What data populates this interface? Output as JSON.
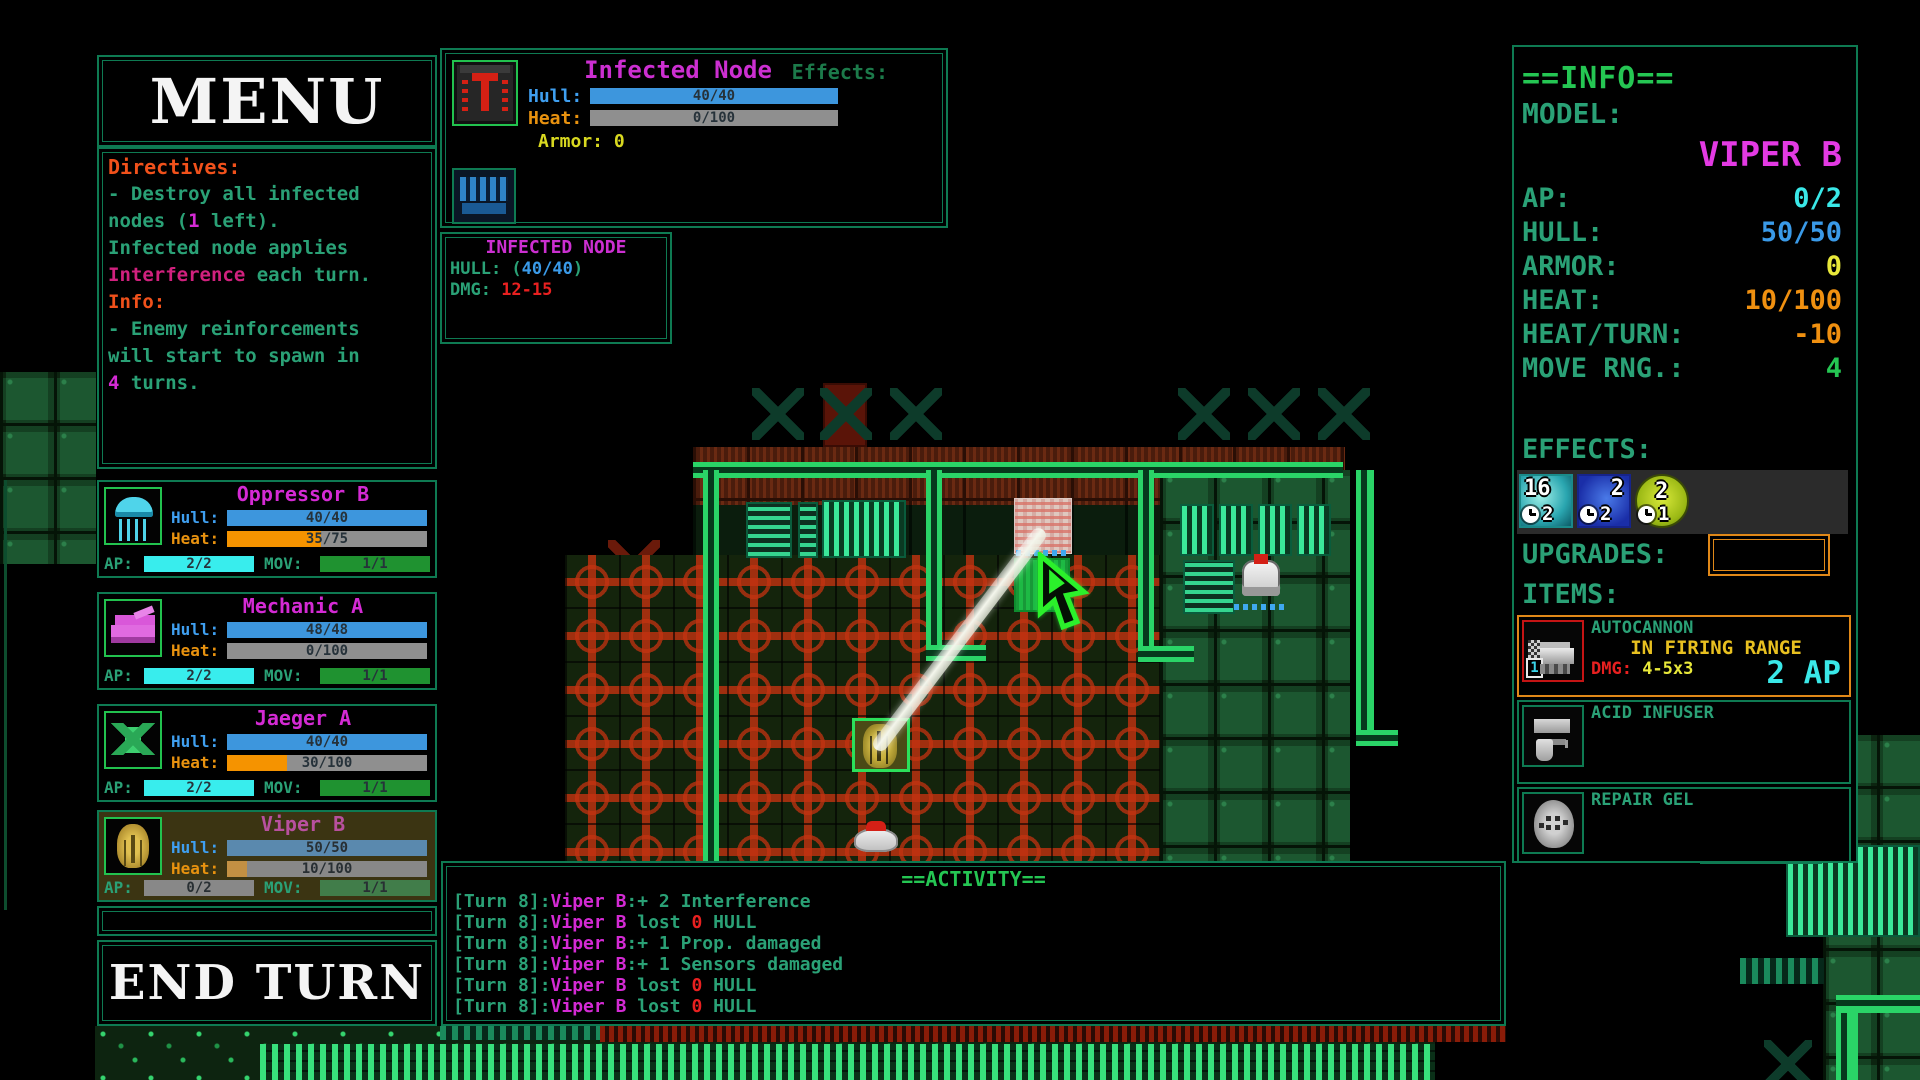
{
  "menu": {
    "title": "MENU",
    "end_turn_label": "END TURN"
  },
  "directives": {
    "title": "Directives:",
    "body": [
      [
        {
          "t": "- Destroy all infected",
          "c": "t-teal"
        }
      ],
      [
        {
          "t": "nodes (",
          "c": "t-teal"
        },
        {
          "t": "1",
          "c": "t-mag"
        },
        {
          "t": " left).",
          "c": "t-teal"
        }
      ],
      [
        {
          "t": "Infected node applies",
          "c": "t-teal"
        }
      ],
      [
        {
          "t": "Interference",
          "c": "t-pink"
        },
        {
          "t": " each turn.",
          "c": "t-teal"
        }
      ],
      [
        {
          "t": "Info:",
          "c": "t-orange"
        }
      ],
      [
        {
          "t": "- Enemy reinforcements",
          "c": "t-teal"
        }
      ],
      [
        {
          "t": "will start to spawn in",
          "c": "t-teal"
        }
      ],
      [
        {
          "t": "4",
          "c": "t-mag"
        },
        {
          "t": " turns.",
          "c": "t-teal"
        }
      ]
    ]
  },
  "labels": {
    "hull": "Hull:",
    "heat": "Heat:",
    "ap": "AP:",
    "mov": "MOV:"
  },
  "units": [
    {
      "name": "Oppressor B",
      "hull": "40/40",
      "heat": "35/75",
      "ap": "2/2",
      "mov": "1/1",
      "portrait": "oppressor",
      "selected": false
    },
    {
      "name": "Mechanic A",
      "hull": "48/48",
      "heat": "0/100",
      "ap": "2/2",
      "mov": "1/1",
      "portrait": "mechanic",
      "selected": false
    },
    {
      "name": "Jaeger A",
      "hull": "40/40",
      "heat": "30/100",
      "ap": "2/2",
      "mov": "1/1",
      "portrait": "jaeger",
      "selected": false
    },
    {
      "name": "Viper B",
      "hull": "50/50",
      "heat": "10/100",
      "ap": "0/2",
      "mov": "1/1",
      "portrait": "viper",
      "selected": true
    }
  ],
  "target": {
    "name": "Infected Node",
    "hull_label": "Hull:",
    "hull": "40/40",
    "heat_label": "Heat:",
    "heat": "0/100",
    "armor_label": "Armor:",
    "armor_value": "0",
    "effects_label": "Effects:"
  },
  "tooltip": {
    "title": "INFECTED NODE",
    "hull_label": "HULL: (",
    "hull_value": "40/40",
    "hull_close": ")",
    "dmg_label": "DMG: ",
    "dmg_value": "12-15"
  },
  "info": {
    "title": "==INFO==",
    "model_label": "MODEL:",
    "model": "VIPER B",
    "rows": [
      {
        "label": "AP:",
        "value": "0/2",
        "color": "rv-cyan"
      },
      {
        "label": "HULL:",
        "value": "50/50",
        "color": "rv-blue"
      },
      {
        "label": "ARMOR:",
        "value": "0",
        "color": "rv-yellow"
      },
      {
        "label": "HEAT:",
        "value": "10/100",
        "color": "rv-orange"
      },
      {
        "label": "HEAT/TURN:",
        "value": "-10",
        "color": "rv-orange"
      },
      {
        "label": "MOVE RNG.:",
        "value": "4",
        "color": "rv-green"
      }
    ],
    "effects_label": "EFFECTS:",
    "effects": [
      {
        "value": "16",
        "turns": "2",
        "style": "fx-teal"
      },
      {
        "value": "2",
        "turns": "2",
        "style": "fx-blue"
      },
      {
        "value": "2",
        "turns": "1",
        "style": "fx-lime"
      }
    ],
    "upgrades_label": "UPGRADES:",
    "items_label": "ITEMS:"
  },
  "items": [
    {
      "name": "AUTOCANNON",
      "status": "IN FIRING RANGE",
      "dmg_label": "DMG: ",
      "dmg": "4-5x3",
      "cost": "2 AP",
      "count": "1",
      "icon": "autocannon",
      "highlight": true
    },
    {
      "name": "ACID INFUSER",
      "icon": "acid",
      "highlight": false
    },
    {
      "name": "REPAIR GEL",
      "icon": "gel",
      "highlight": false
    }
  ],
  "activity": {
    "title": "==ACTIVITY==",
    "lines": [
      {
        "turn": "[Turn 8]:",
        "unit": "Viper B",
        "mid": ":+ 2 Interference",
        "num": "",
        "tail": ""
      },
      {
        "turn": "[Turn 8]:",
        "unit": "Viper B",
        "mid": " lost ",
        "num": "0",
        "tail": " HULL"
      },
      {
        "turn": "[Turn 8]:",
        "unit": "Viper B",
        "mid": ":+ 1 Prop. damaged",
        "num": "",
        "tail": ""
      },
      {
        "turn": "[Turn 8]:",
        "unit": "Viper B",
        "mid": ":+ 1 Sensors damaged",
        "num": "",
        "tail": ""
      },
      {
        "turn": "[Turn 8]:",
        "unit": "Viper B",
        "mid": " lost ",
        "num": "0",
        "tail": " HULL"
      },
      {
        "turn": "[Turn 8]:",
        "unit": "Viper B",
        "mid": " lost ",
        "num": "0",
        "tail": " HULL"
      }
    ]
  },
  "colors": {
    "teal_text": "#2aa176",
    "bright_green": "#25c653",
    "magenta": "#d42ad4",
    "hull_blue": "#3d96dd",
    "heat_orange": "#f59300",
    "ap_cyan": "#38eded",
    "mov_green": "#1f9230",
    "alert_orange": "#f1511b",
    "damage_red": "#e82020"
  }
}
